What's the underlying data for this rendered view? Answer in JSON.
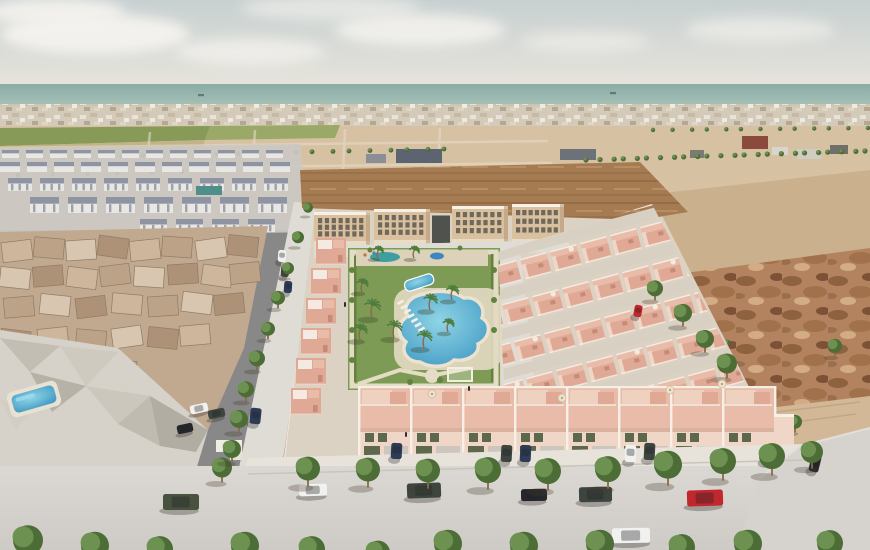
{
  "scene": {
    "description": "Aerial 3D architectural render of a new-build salmon-pink residential complex with a communal lagoon pool and gardens, bordered by an existing town on the left, bare desert land on the right, farmland and the sea on the horizon",
    "type": "architectural-visualization"
  },
  "palette": {
    "sky_top": "#c7d0d0",
    "sky_horizon": "#e7e4dc",
    "cloud": "#f5f3ef",
    "sea_top": "#8aada4",
    "sea_bot": "#a6c1b8",
    "town": "#cfc3b1",
    "field": "#879a58",
    "field_light": "#9aa868",
    "desert": "#d7c1a3",
    "desert_deep": "#cbb08d",
    "sand_track": "#d2b896",
    "rough": "#b3835f",
    "mound": "#a57c52",
    "oldtown_base": "#c1a98f",
    "rock": "#d6d2ca",
    "road": "#d6d3ce",
    "road_light": "#dfdcd6",
    "sidewalk": "#e7e3db",
    "lane": "#d8d0c2",
    "dev_base": "#dbd2c3",
    "pink_wall": "#dfa995",
    "pink_roof": "#e8bca9",
    "pink_light": "#f0d6c6",
    "pink_deep": "#c68b78",
    "white_trim": "#f6f0e7",
    "apt_wall": "#d9c09f",
    "apt_shadow": "#b59876",
    "win": "#55514a",
    "green_shutter": "#5d684c",
    "lawn": "#7d9b55",
    "lawn_dark": "#63823f",
    "path": "#e5dcc6",
    "pool1": "#8fd4e6",
    "pool2": "#3e97c2",
    "teal": "#3f9f9f",
    "tree": "#6d9150",
    "tree_dark": "#4c6d36",
    "palm": "#4e7c3c",
    "trunk": "#8a6a4a",
    "estate_white": "#e9e7e3",
    "estate_dark": "#7e8596",
    "car_white": "#f1f1ef",
    "car_dark": "#3e443e",
    "car_black": "#25272b",
    "car_red": "#c1272d",
    "car_navy": "#2d3b56",
    "car_green": "#49523f"
  },
  "clouds": [
    [
      95,
      34,
      95,
      20,
      0.95
    ],
    [
      250,
      52,
      75,
      14,
      0.7
    ],
    [
      420,
      30,
      85,
      16,
      0.85
    ],
    [
      585,
      42,
      65,
      11,
      0.55
    ],
    [
      760,
      30,
      75,
      13,
      0.6
    ],
    [
      55,
      12,
      70,
      14,
      0.9
    ],
    [
      330,
      8,
      90,
      12,
      0.6
    ]
  ],
  "horizon": {
    "ships": [
      [
        198,
        94
      ],
      [
        610,
        92
      ]
    ]
  },
  "tree_rows": [
    {
      "x1": 588,
      "y1": 161,
      "x2": 866,
      "y2": 152,
      "n": 24,
      "r": 2.6
    },
    {
      "x1": 556,
      "y1": 208,
      "x2": 726,
      "y2": 344,
      "n": 15,
      "r": 3.4
    },
    {
      "x1": 548,
      "y1": 224,
      "x2": 665,
      "y2": 243,
      "n": 10,
      "r": 4
    },
    {
      "x1": 655,
      "y1": 131,
      "x2": 866,
      "y2": 129,
      "n": 13,
      "r": 2.2
    },
    {
      "x1": 66,
      "y1": 158,
      "x2": 446,
      "y2": 150,
      "n": 21,
      "r": 2.4
    },
    {
      "x1": 20,
      "y1": 176,
      "x2": 282,
      "y2": 171,
      "n": 9,
      "r": 2.2
    }
  ],
  "structures": {
    "warehouses_mid": [
      [
        396,
        149,
        46,
        14,
        "#5c6471"
      ],
      [
        366,
        154,
        20,
        9,
        "#8b8e96"
      ],
      [
        560,
        149,
        36,
        11,
        "#6d7279"
      ]
    ],
    "topright_buildings": [
      [
        742,
        136,
        26,
        13,
        "#8a4a3c"
      ],
      [
        772,
        147,
        16,
        8,
        "#d8d5cb"
      ],
      [
        797,
        149,
        24,
        10,
        "#cfccc2"
      ],
      [
        830,
        145,
        18,
        9,
        "#6f7168"
      ],
      [
        690,
        150,
        14,
        8,
        "#7a7c72"
      ]
    ],
    "dark_cluster": [
      [
        547,
        196,
        20,
        14,
        "#63655c"
      ],
      [
        566,
        188,
        16,
        12,
        "#565851"
      ],
      [
        584,
        196,
        22,
        16,
        "#6e7066"
      ],
      [
        607,
        190,
        18,
        13,
        "#5a5c54"
      ],
      [
        625,
        198,
        20,
        15,
        "#73756b"
      ],
      [
        596,
        214,
        24,
        14,
        "#50524b"
      ],
      [
        552,
        214,
        18,
        12,
        "#7b7d73"
      ],
      [
        629,
        216,
        16,
        12,
        "#5f6159"
      ]
    ],
    "sports_court": [
      196,
      186,
      26,
      9,
      "#4e8f8a"
    ]
  },
  "estate_rows": [
    {
      "y": 150,
      "x0": 2,
      "n": 12,
      "dx": 24,
      "w": 17,
      "h": 8
    },
    {
      "y": 162,
      "x0": 0,
      "n": 11,
      "dx": 27,
      "w": 20,
      "h": 10
    },
    {
      "y": 178,
      "x0": 8,
      "n": 9,
      "dx": 32,
      "w": 24,
      "h": 13
    },
    {
      "y": 197,
      "x0": 30,
      "n": 7,
      "dx": 38,
      "w": 29,
      "h": 16
    },
    {
      "y": 219,
      "x0": 140,
      "n": 4,
      "dx": 36,
      "w": 27,
      "h": 13
    }
  ],
  "oldtown_houses": [
    [
      2,
      241,
      -7,
      0
    ],
    [
      34,
      238,
      5,
      1
    ],
    [
      66,
      240,
      -4,
      2
    ],
    [
      98,
      237,
      8,
      3
    ],
    [
      130,
      240,
      -6,
      0
    ],
    [
      162,
      237,
      4,
      1
    ],
    [
      196,
      239,
      -8,
      2
    ],
    [
      228,
      236,
      6,
      3
    ],
    [
      0,
      268,
      6,
      2
    ],
    [
      33,
      266,
      -5,
      3
    ],
    [
      67,
      268,
      7,
      0
    ],
    [
      100,
      265,
      -7,
      1
    ],
    [
      134,
      267,
      4,
      2
    ],
    [
      168,
      264,
      -4,
      3
    ],
    [
      202,
      266,
      8,
      0
    ],
    [
      230,
      263,
      -6,
      1
    ],
    [
      4,
      297,
      -5,
      1
    ],
    [
      40,
      295,
      6,
      2
    ],
    [
      76,
      297,
      -7,
      3
    ],
    [
      112,
      294,
      5,
      0
    ],
    [
      148,
      296,
      -4,
      1
    ],
    [
      182,
      293,
      7,
      2
    ],
    [
      214,
      294,
      -6,
      3
    ],
    [
      0,
      330,
      7,
      3
    ],
    [
      38,
      328,
      -6,
      0
    ],
    [
      76,
      330,
      5,
      1
    ],
    [
      112,
      327,
      -8,
      2
    ],
    [
      148,
      328,
      6,
      3
    ],
    [
      180,
      325,
      -5,
      0
    ],
    [
      0,
      363,
      -6,
      2
    ],
    [
      36,
      361,
      5,
      3
    ],
    [
      72,
      362,
      -7,
      0
    ],
    [
      106,
      360,
      6,
      1
    ],
    [
      2,
      394,
      5,
      0
    ],
    [
      36,
      392,
      -6,
      1
    ],
    [
      70,
      392,
      4,
      2
    ]
  ],
  "apartments": {
    "blocks": [
      [
        314,
        212,
        56,
        34
      ],
      [
        374,
        209,
        56,
        36
      ],
      [
        452,
        206,
        56,
        38
      ],
      [
        512,
        204,
        52,
        40
      ]
    ],
    "gate": [
      432,
      213,
      18,
      30
    ],
    "win_rows": 3,
    "win_cols": 7
  },
  "right_block": {
    "rows": 7,
    "units": 8,
    "start": [
      448,
      238
    ],
    "row_step": [
      12,
      37
    ],
    "unit_step": [
      30,
      -8
    ],
    "unit_w": 27,
    "unit_h": 21,
    "rot": -15
  },
  "left_column": {
    "n": 6,
    "x0": 316,
    "y0": 238,
    "dx": -5,
    "dy": 30,
    "w": 30,
    "h": 27
  },
  "front_row": {
    "x0": 358,
    "unit_w": 52,
    "n": 8,
    "umbrellas": [
      1,
      3,
      6
    ]
  },
  "loungers": {
    "x": 397,
    "y": 301,
    "n": 7,
    "dx": 3.5,
    "dy": 4.5,
    "w": 7,
    "h": 2.6,
    "rot": -28
  },
  "palms": [
    [
      372,
      318,
      13
    ],
    [
      360,
      340,
      11
    ],
    [
      394,
      338,
      12
    ],
    [
      430,
      310,
      11
    ],
    [
      424,
      348,
      12
    ],
    [
      452,
      300,
      10
    ],
    [
      362,
      292,
      9
    ],
    [
      448,
      332,
      9
    ],
    [
      414,
      258,
      8
    ],
    [
      378,
      258,
      8
    ]
  ],
  "shrubs": [
    [
      352,
      270,
      3
    ],
    [
      352,
      300,
      3
    ],
    [
      352,
      330,
      3
    ],
    [
      352,
      360,
      3
    ],
    [
      494,
      270,
      3
    ],
    [
      494,
      300,
      3
    ],
    [
      494,
      330,
      3
    ],
    [
      440,
      380,
      3
    ],
    [
      410,
      382,
      3
    ],
    [
      370,
      250,
      2.5
    ],
    [
      460,
      248,
      2.5
    ]
  ],
  "trees": {
    "sidewalk": [
      [
        222,
        482,
        10
      ],
      [
        308,
        486,
        12
      ],
      [
        368,
        487,
        12
      ],
      [
        428,
        488,
        12
      ],
      [
        488,
        489,
        13
      ],
      [
        548,
        490,
        13
      ],
      [
        608,
        488,
        13
      ],
      [
        668,
        485,
        14
      ],
      [
        723,
        480,
        13
      ],
      [
        772,
        475,
        13
      ],
      [
        812,
        468,
        11
      ]
    ],
    "bottom": [
      [
        28,
        562,
        15
      ],
      [
        95,
        566,
        14
      ],
      [
        160,
        568,
        13
      ],
      [
        245,
        566,
        14
      ],
      [
        312,
        568,
        13
      ],
      [
        378,
        570,
        12
      ],
      [
        448,
        564,
        14
      ],
      [
        524,
        566,
        14
      ],
      [
        600,
        564,
        14
      ],
      [
        682,
        566,
        13
      ],
      [
        748,
        564,
        14
      ],
      [
        830,
        562,
        13
      ]
    ],
    "left_street": [
      [
        308,
        215,
        5
      ],
      [
        298,
        246,
        6
      ],
      [
        288,
        277,
        6
      ],
      [
        278,
        308,
        7
      ],
      [
        268,
        339,
        7
      ],
      [
        257,
        370,
        8
      ],
      [
        246,
        401,
        8
      ],
      [
        239,
        432,
        9
      ],
      [
        232,
        462,
        9
      ]
    ],
    "block_edge": [
      [
        655,
        300,
        8
      ],
      [
        683,
        326,
        9
      ],
      [
        705,
        352,
        9
      ],
      [
        727,
        378,
        10
      ],
      [
        835,
        356,
        7
      ],
      [
        795,
        432,
        7
      ]
    ]
  },
  "cars": [
    [
      163,
      494,
      36,
      16,
      "green",
      0
    ],
    [
      299,
      484,
      28,
      12,
      "white",
      -2
    ],
    [
      407,
      483,
      34,
      15,
      "dark",
      -2
    ],
    [
      521,
      489,
      26,
      12,
      "black",
      -1
    ],
    [
      579,
      487,
      33,
      15,
      "dark",
      -1
    ],
    [
      687,
      490,
      36,
      16,
      "red",
      -2
    ],
    [
      612,
      528,
      38,
      15,
      "white",
      -1
    ],
    [
      190,
      404,
      18,
      9,
      "white",
      -12
    ],
    [
      208,
      409,
      17,
      9,
      "dark",
      -12
    ],
    [
      177,
      424,
      16,
      9,
      "black",
      -12
    ],
    [
      250,
      408,
      11,
      16,
      "navy",
      6
    ],
    [
      391,
      443,
      11,
      16,
      "navy",
      3
    ],
    [
      501,
      445,
      11,
      17,
      "dark",
      3
    ],
    [
      520,
      445,
      11,
      17,
      "navy",
      3
    ],
    [
      625,
      445,
      11,
      17,
      "white",
      3
    ],
    [
      644,
      443,
      11,
      17,
      "dark",
      3
    ],
    [
      761,
      445,
      12,
      18,
      "white",
      5
    ],
    [
      810,
      455,
      10,
      17,
      "black",
      14
    ],
    [
      634,
      305,
      8,
      12,
      "red",
      10
    ],
    [
      278,
      250,
      8,
      12,
      "white",
      4
    ],
    [
      281,
      265,
      8,
      12,
      "dark",
      4
    ],
    [
      284,
      281,
      8,
      12,
      "navy",
      4
    ]
  ],
  "parasols": [
    [
      432,
      394
    ],
    [
      562,
      398
    ],
    [
      670,
      390
    ],
    [
      722,
      384
    ]
  ],
  "people": [
    [
      468,
      386
    ],
    [
      405,
      432
    ],
    [
      344,
      302
    ]
  ]
}
